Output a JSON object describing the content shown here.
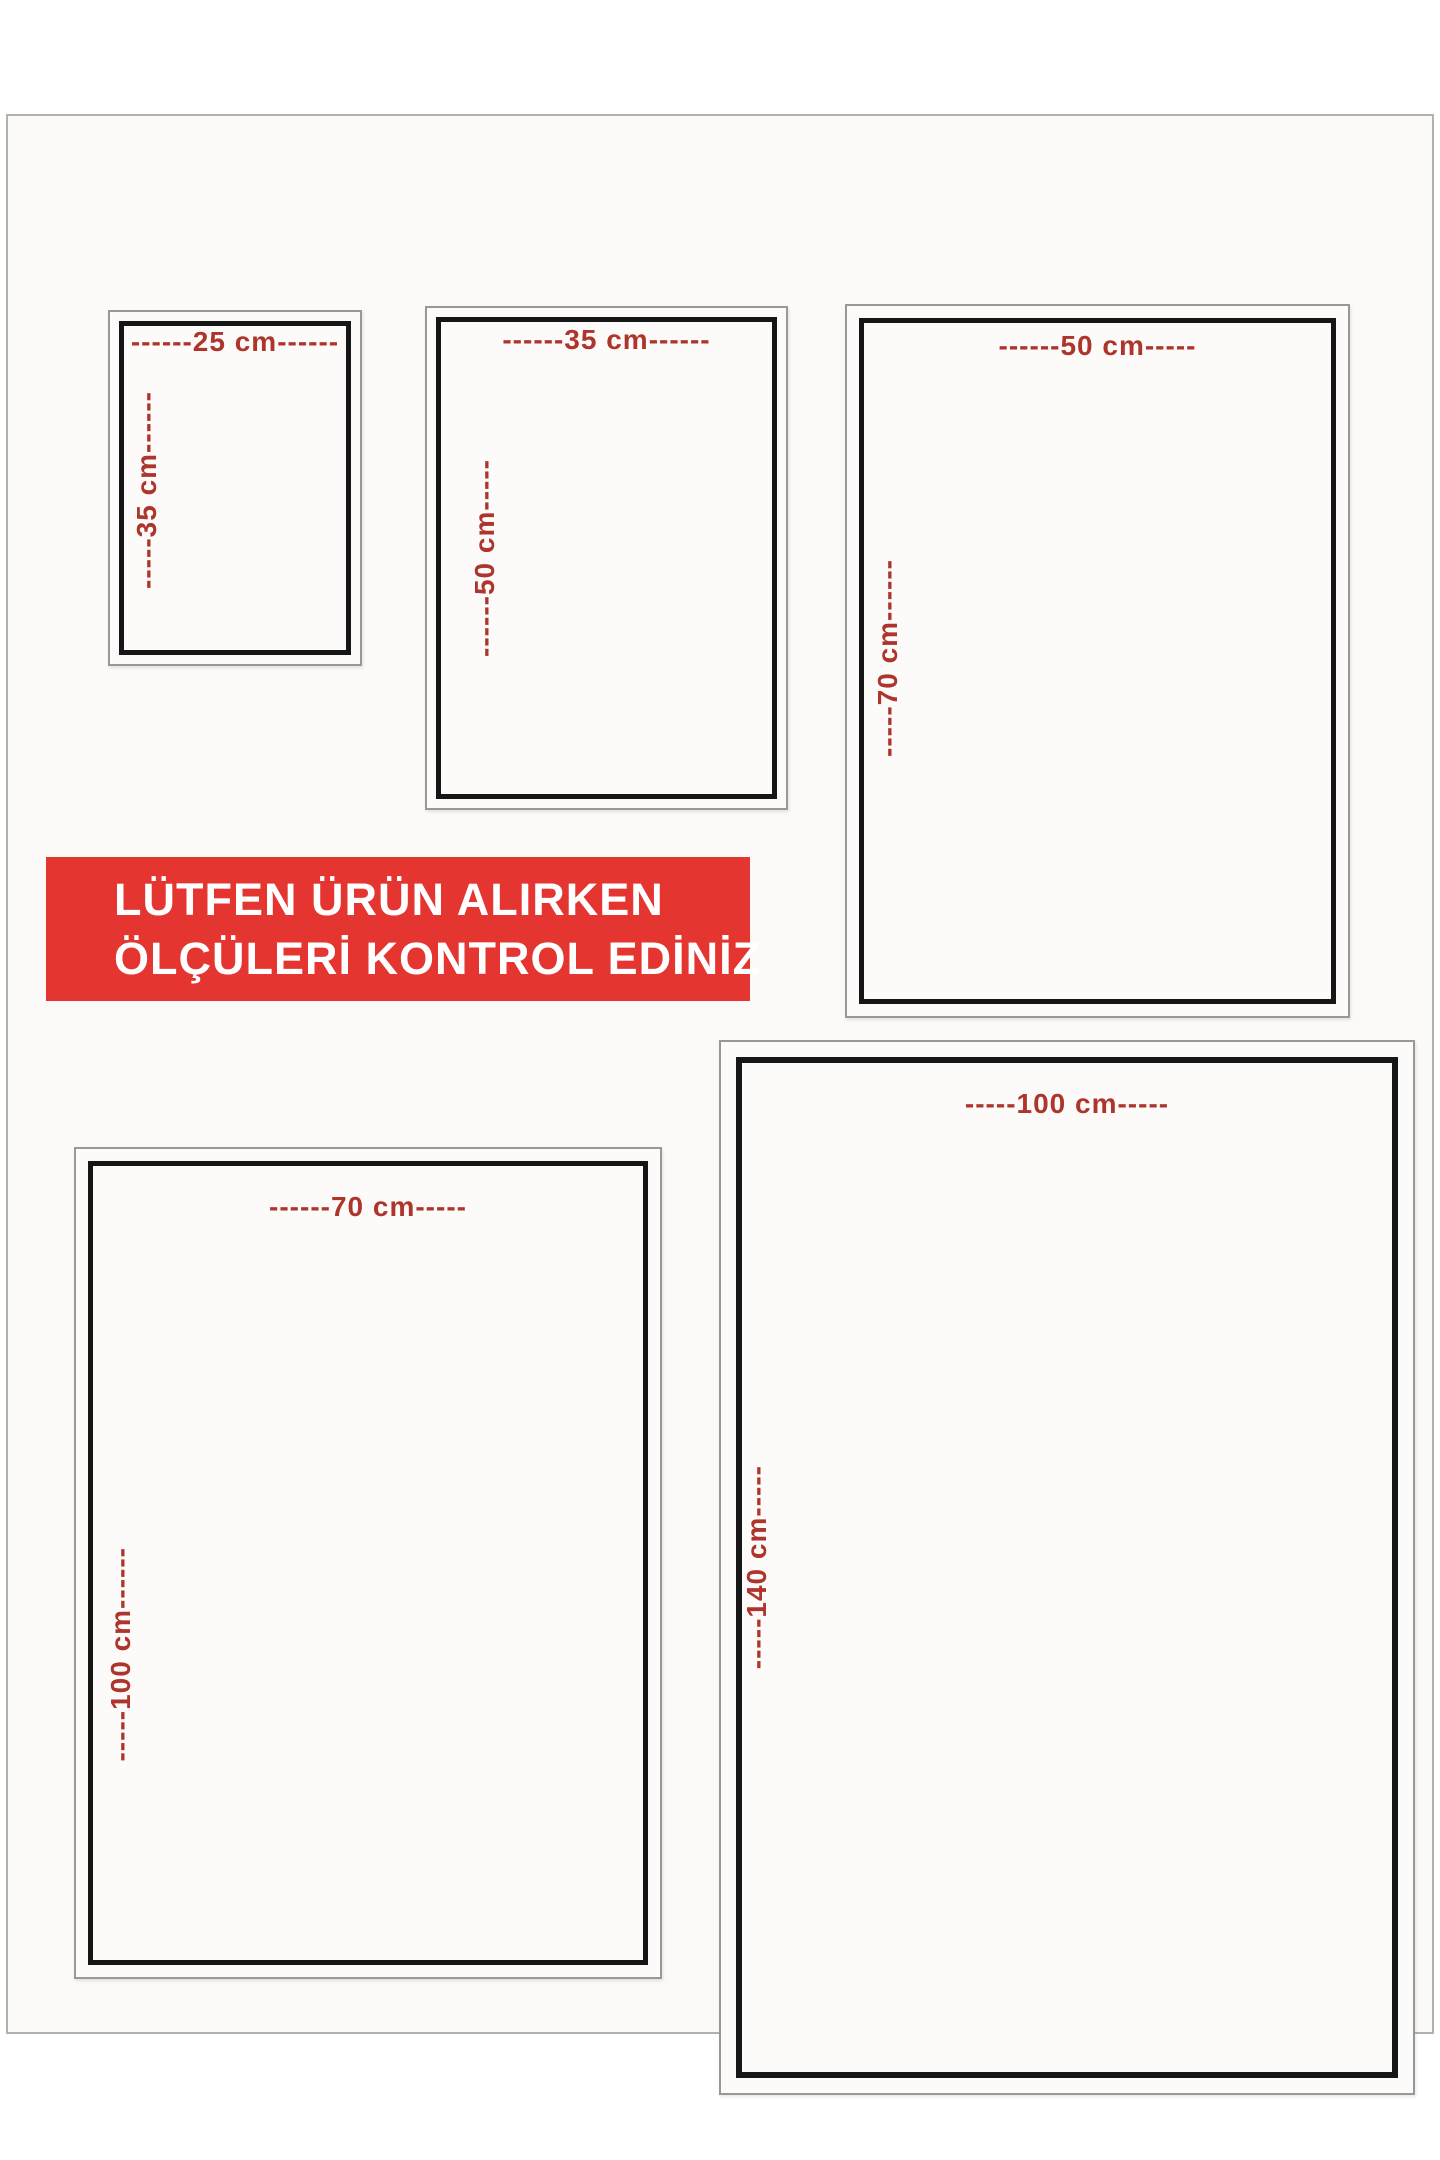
{
  "banner": {
    "line1": "LÜTFEN ÜRÜN ALIRKEN",
    "line2": "ÖLÇÜLERİ KONTROL EDİNİZ",
    "bg_color": "#e43530",
    "text_color": "#ffffff"
  },
  "colors": {
    "dimension_text": "#ad352c",
    "frame_inner_border": "#161616",
    "frame_outer_border": "#9a9896",
    "page_background": "#fbfaf8"
  },
  "sizes": [
    {
      "id": "25x35",
      "width_cm": 25,
      "height_cm": 35,
      "width_label": "------25 cm------",
      "height_label": "-----35 cm------"
    },
    {
      "id": "35x50",
      "width_cm": 35,
      "height_cm": 50,
      "width_label": "------35 cm------",
      "height_label": "------50 cm-----"
    },
    {
      "id": "50x70",
      "width_cm": 50,
      "height_cm": 70,
      "width_label": "------50 cm-----",
      "height_label": "-----70 cm------"
    },
    {
      "id": "70x100",
      "width_cm": 70,
      "height_cm": 100,
      "width_label": "------70 cm-----",
      "height_label": "-----100 cm------"
    },
    {
      "id": "100x140",
      "width_cm": 100,
      "height_cm": 140,
      "width_label": "-----100 cm-----",
      "height_label": "-----140 cm-----"
    }
  ]
}
